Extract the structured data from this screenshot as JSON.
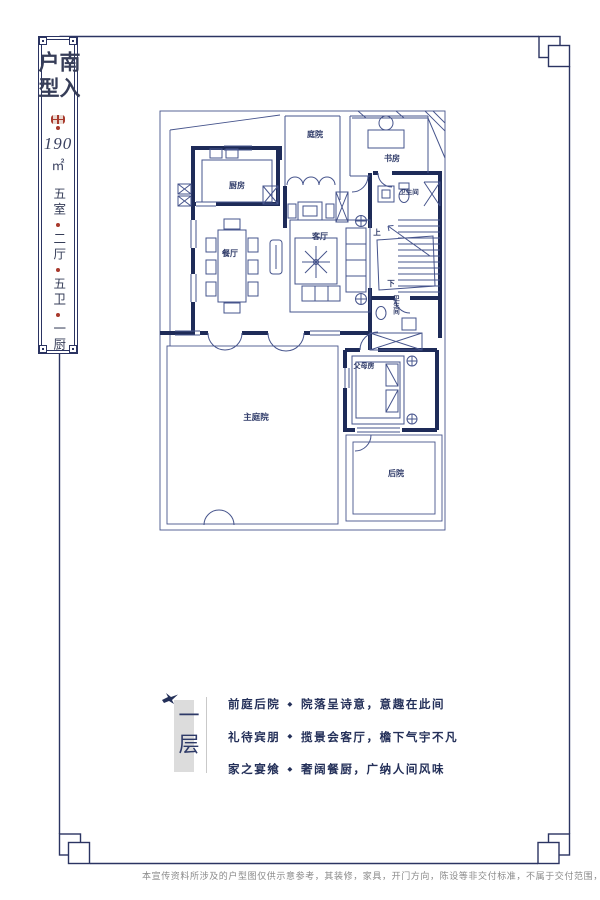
{
  "colors": {
    "wall": "#1e2b58",
    "thin_line": "#46548c",
    "label_text": "#2e3a68",
    "accent_red": "#a8392c",
    "frame": "#2b3462",
    "gray_bar": "#dcdcdc",
    "disclaimer_text": "#8a8a8a"
  },
  "icons": {
    "seal": "red-seal-stamp-icon",
    "bird": "swallow-bird-icon"
  },
  "title_panel": {
    "title": "南入户型",
    "area_value": "190",
    "area_unit": "㎡",
    "spec_items": [
      "五室",
      "二厅",
      "五卫",
      "一厨"
    ]
  },
  "floor_plan": {
    "rooms": [
      "庭院",
      "书房",
      "厨房",
      "卫生间",
      "餐厅",
      "客厅",
      "卫生间",
      "父母房",
      "主庭院",
      "后院"
    ],
    "stairs_up": "上",
    "stairs_down": "下"
  },
  "section": {
    "floor_label": "一层",
    "separator": "◆",
    "lines": [
      {
        "head": "前庭后院",
        "body": "院落呈诗意，意趣在此间"
      },
      {
        "head": "礼待宾朋",
        "body": "揽景会客厅，檐下气宇不凡"
      },
      {
        "head": "家之宴飨",
        "body": "奢阔餐厨，广纳人间风味"
      }
    ]
  },
  "disclaimer": "本宣传资料所涉及的户型图仅供示意参考，其装修，家具，开门方向，陈设等非交付标准，不属于交付范围，不同户型的图"
}
